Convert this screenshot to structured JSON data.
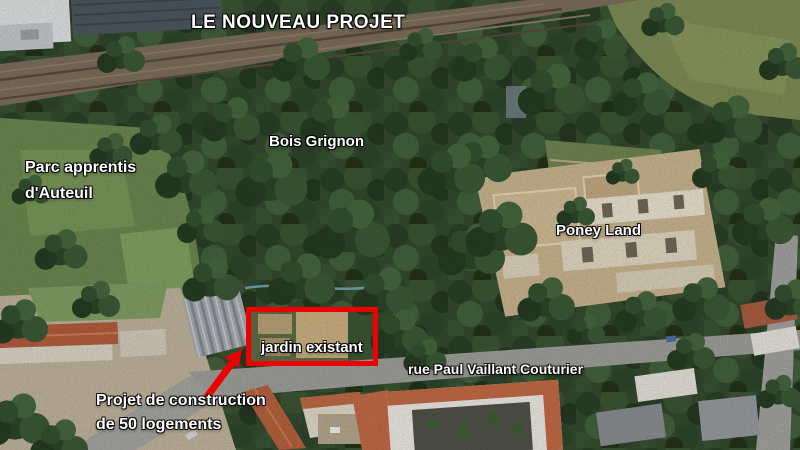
{
  "page": {
    "title": "LE NOUVEAU PROJET"
  },
  "map_labels": {
    "parc": "Parc apprentis\nd'Auteuil",
    "bois": "Bois Grignon",
    "poney": "Poney Land",
    "jardin": "jardin existant",
    "rue": "rue Paul Vaillant Couturier",
    "projet": "Projet de construction\nde 50 logements"
  },
  "annotation": {
    "highlight_color": "#ee0000",
    "label_text_color": "#ffffff"
  }
}
